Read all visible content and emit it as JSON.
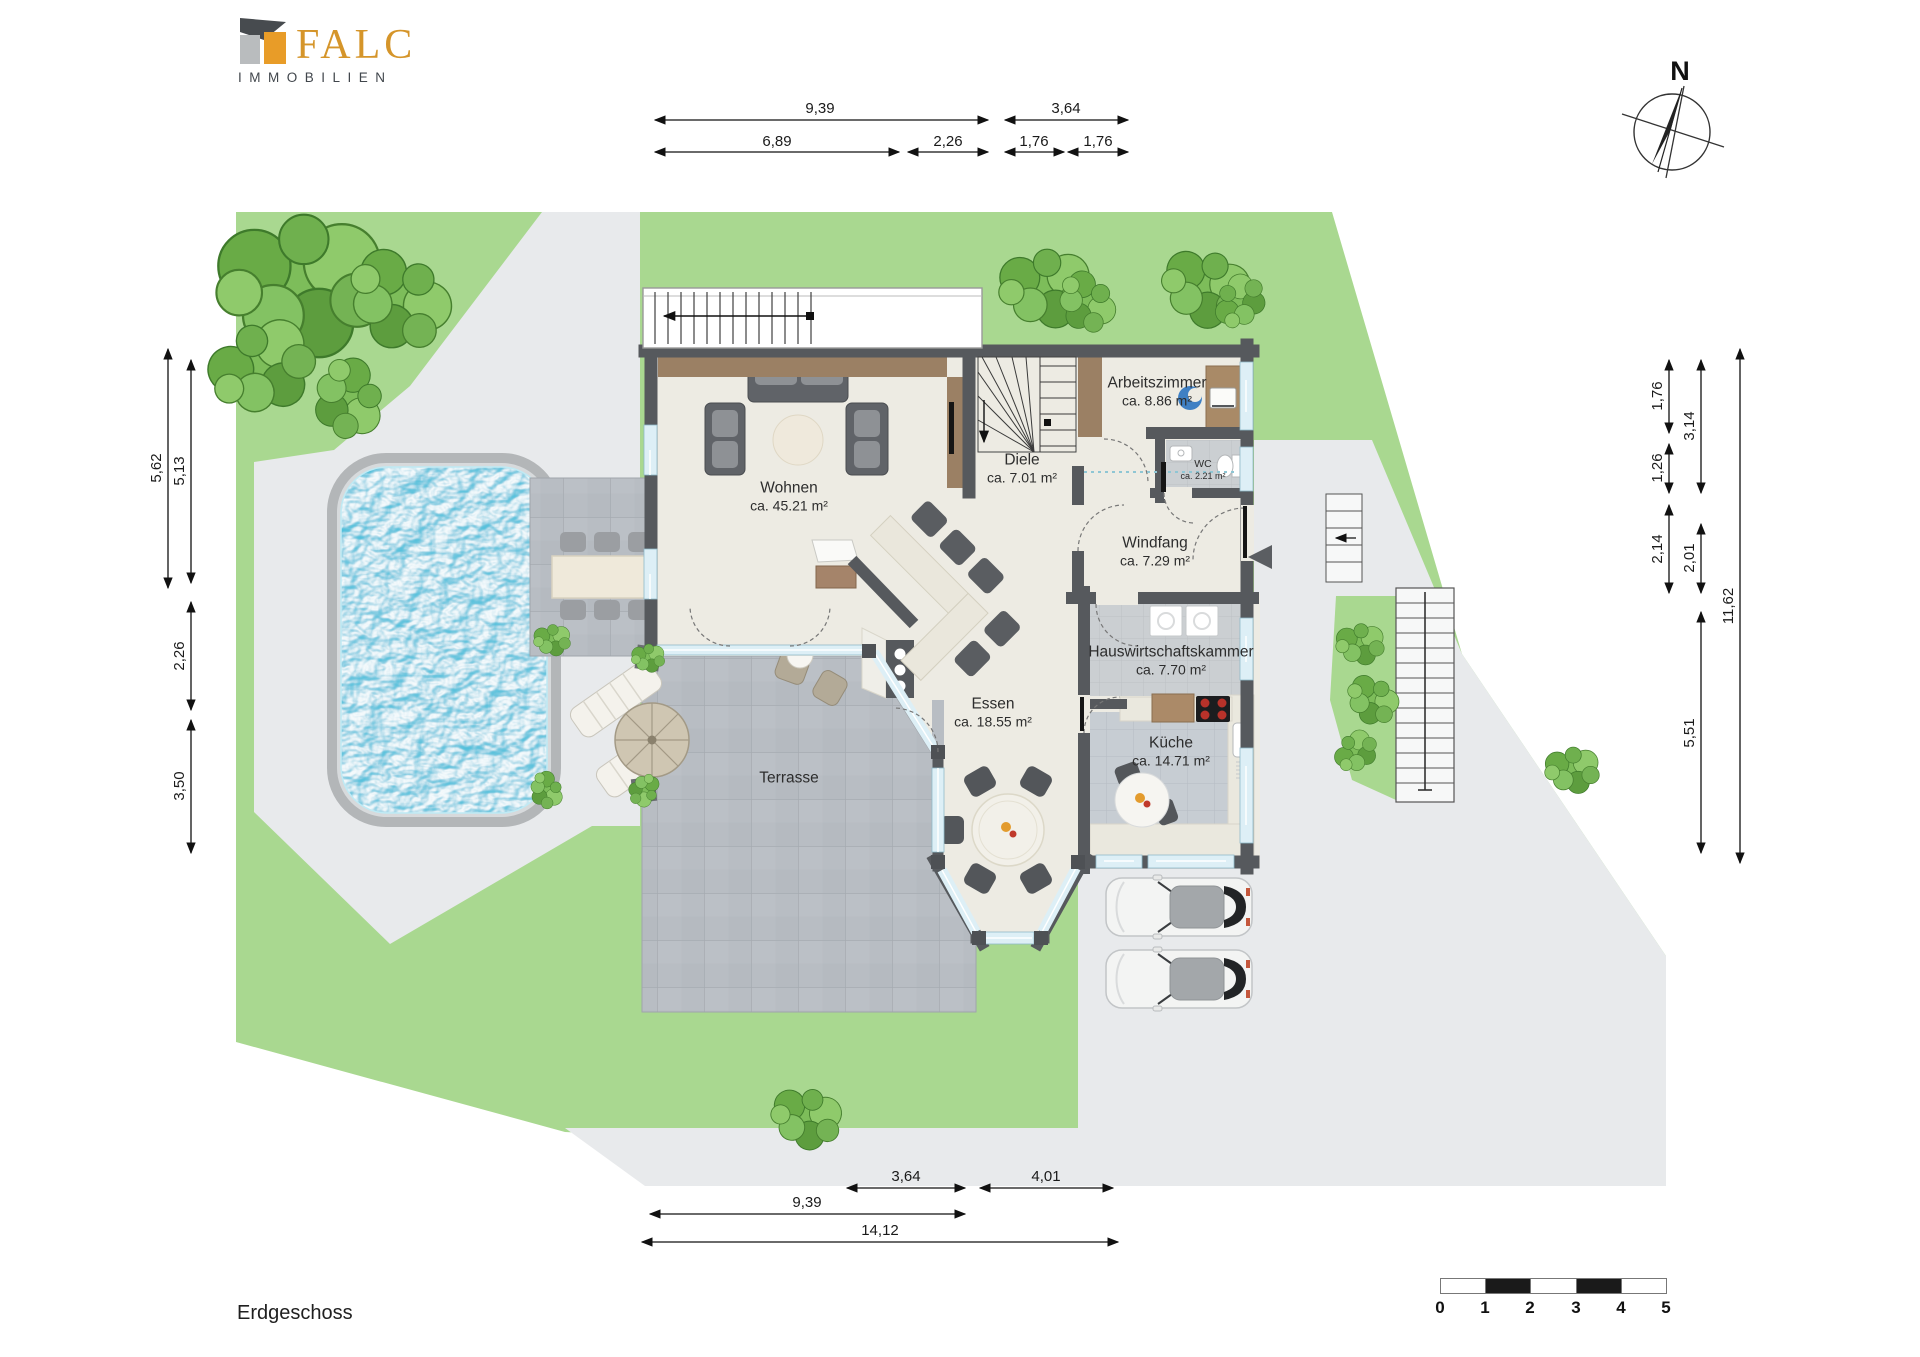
{
  "brand": {
    "name": "FALC",
    "subtitle": "IMMOBILIEN"
  },
  "plan": {
    "floor_label": "Erdgeschoss",
    "north_label": "N"
  },
  "rooms": {
    "wohnen": {
      "name": "Wohnen",
      "area": "ca. 45.21 m²"
    },
    "diele": {
      "name": "Diele",
      "area": "ca. 7.01 m²"
    },
    "arbeitszimmer": {
      "name": "Arbeitszimmer",
      "area": "ca. 8.86 m²"
    },
    "wc": {
      "name": "WC",
      "area": "ca. 2.21 m²"
    },
    "windfang": {
      "name": "Windfang",
      "area": "ca. 7.29 m²"
    },
    "hauswirtschaftskammer": {
      "name": "Hauswirtschaftskammer",
      "area": "ca. 7.70 m²"
    },
    "kueche": {
      "name": "Küche",
      "area": "ca. 14.71 m²"
    },
    "essen": {
      "name": "Essen",
      "area": "ca. 18.55 m²"
    },
    "terrasse": {
      "name": "Terrasse"
    }
  },
  "dimensions": {
    "top": [
      "9,39",
      "3,64",
      "6,89",
      "2,26",
      "1,76",
      "1,76"
    ],
    "left": [
      "5,62",
      "5,13",
      "2,26",
      "3,50"
    ],
    "right": [
      "1,76",
      "1,26",
      "2,14",
      "3,14",
      "2,01",
      "5,51",
      "11,62"
    ],
    "bottom": [
      "3,64",
      "4,01",
      "9,39",
      "14,12"
    ]
  },
  "scale_bar": {
    "labels": [
      "0",
      "1",
      "2",
      "3",
      "4",
      "5"
    ]
  },
  "colors": {
    "lawn": "#a9d890",
    "pavement": "#e8eaec",
    "terrace_tile": "#b8bdc3",
    "wall": "#56595d",
    "wood": "#9b8064",
    "water": "#4fc0db",
    "window": "#ddeff6",
    "brand_gold": "#d5952a",
    "brand_dark": "#41464c"
  }
}
